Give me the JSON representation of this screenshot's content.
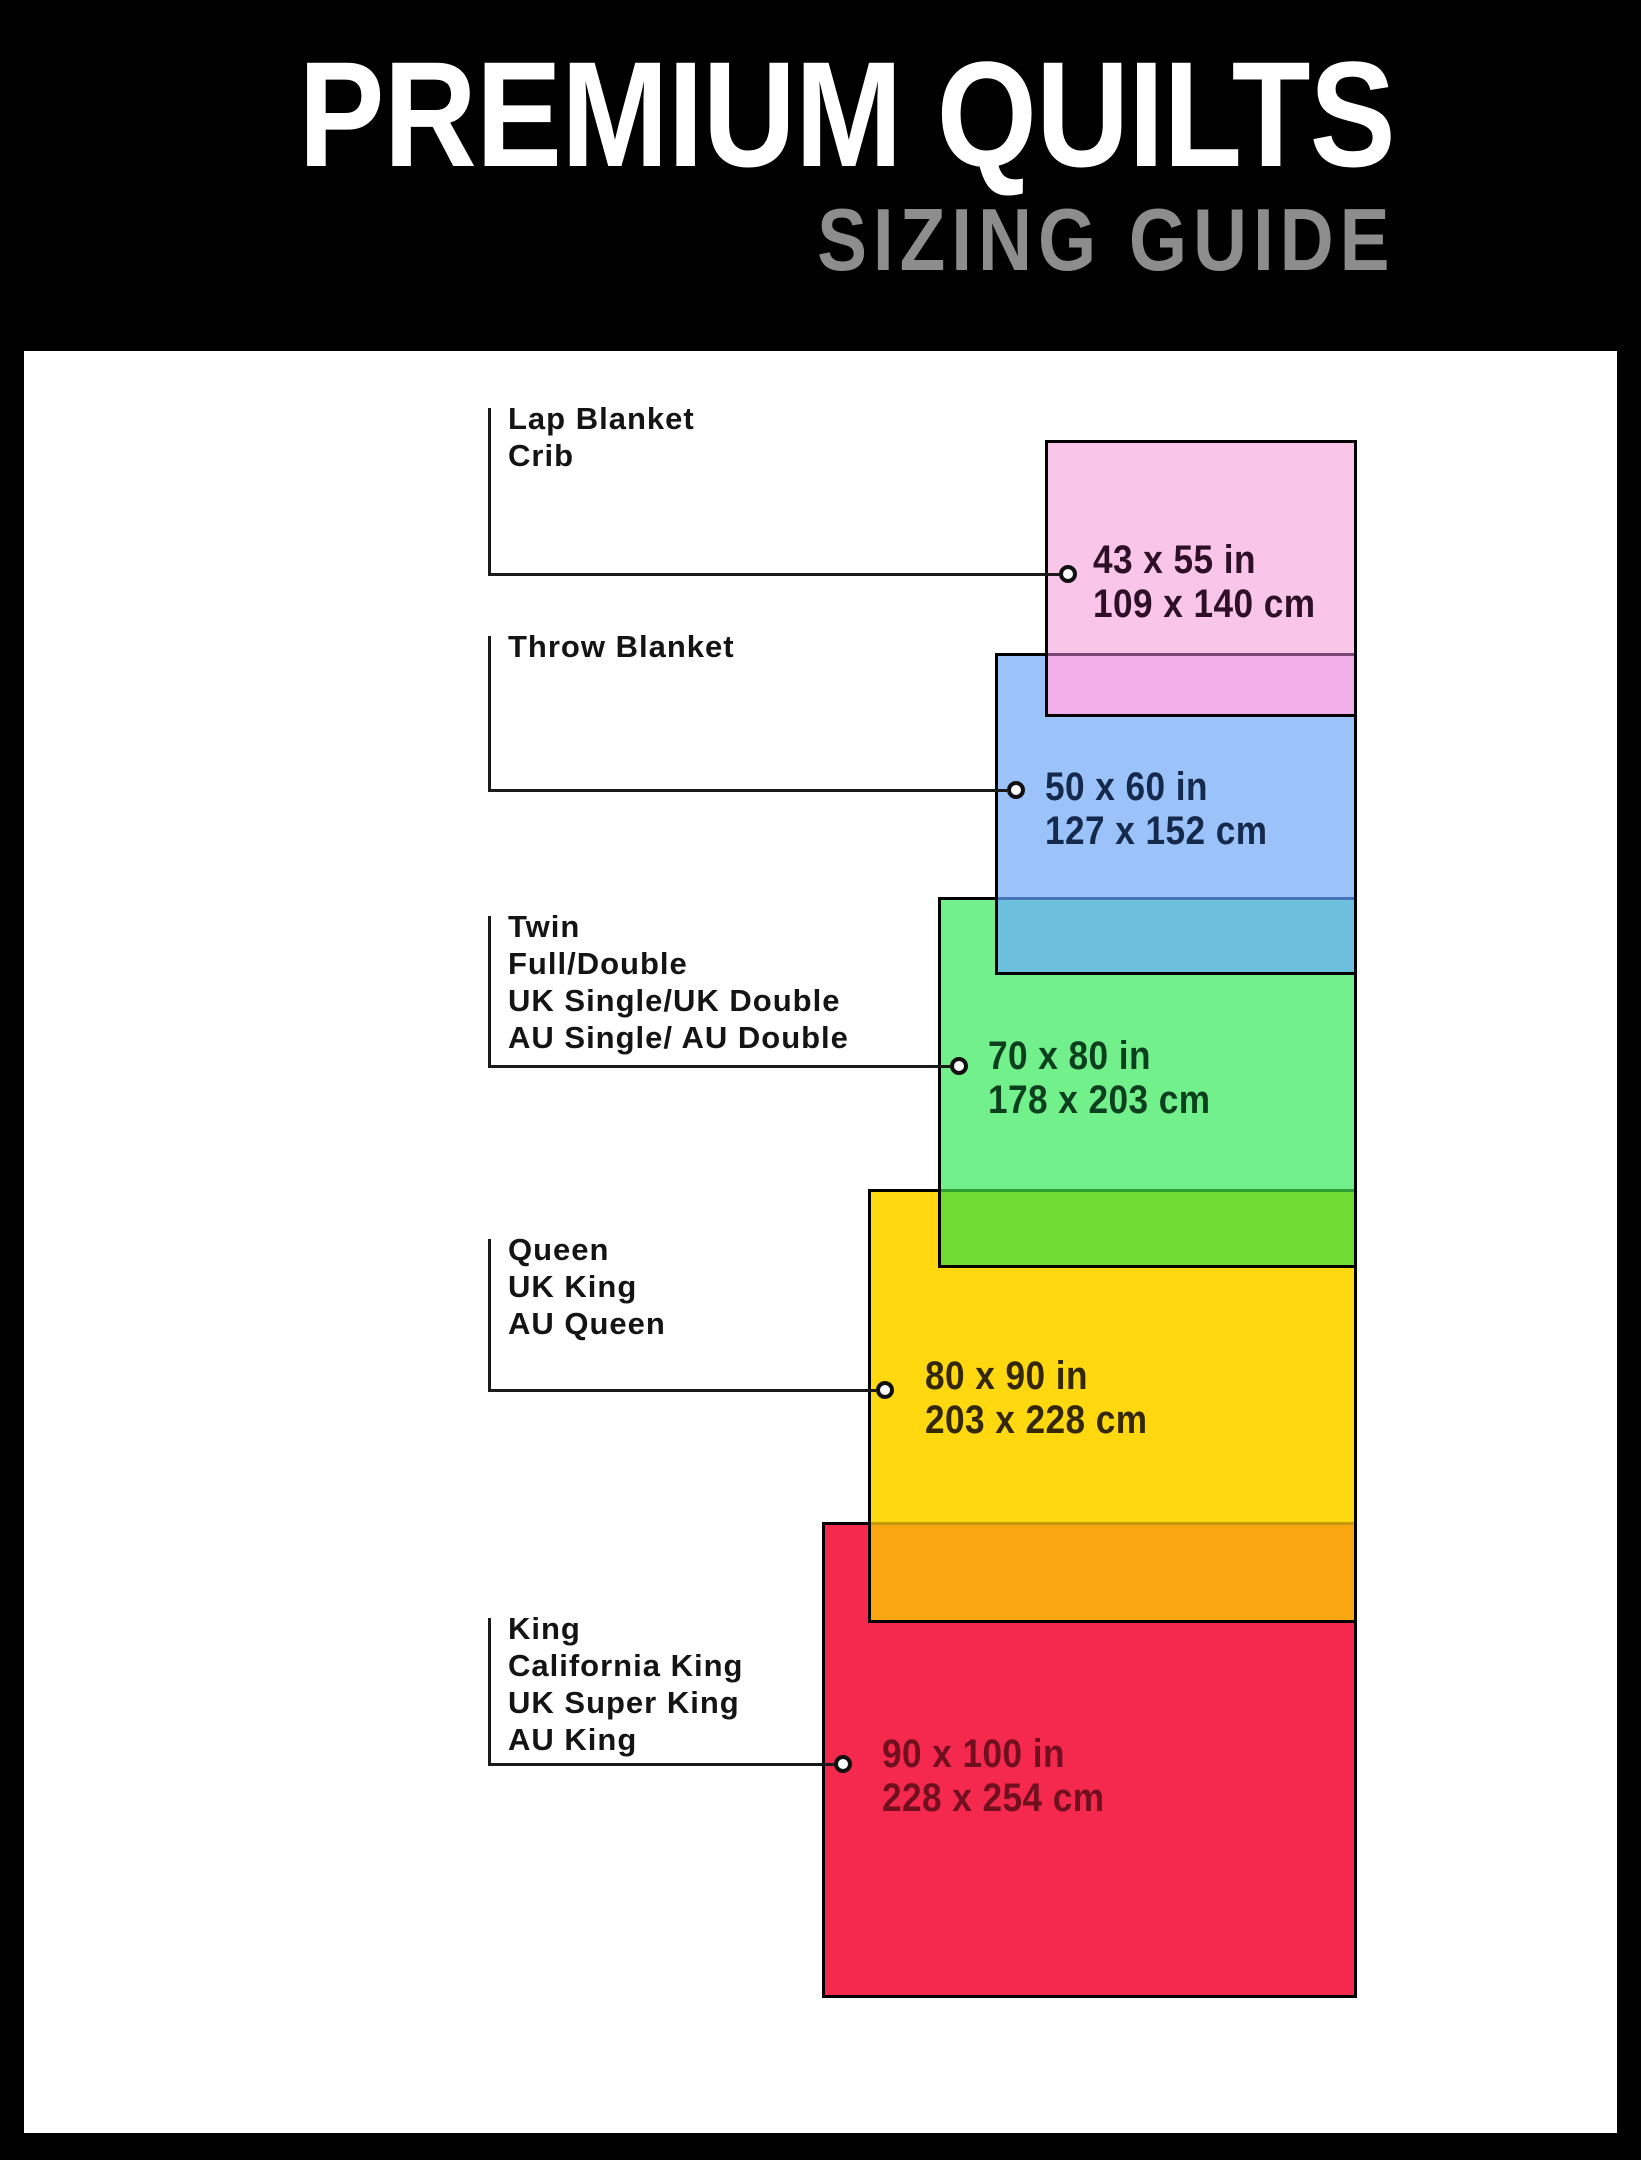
{
  "header": {
    "title": "PREMIUM QUILTS",
    "subtitle": "SIZING GUIDE"
  },
  "colors": {
    "background": "#000000",
    "panel": "#ffffff",
    "title_text": "#ffffff",
    "subtitle_text": "#8d8d8d",
    "line": "#1a1a1a",
    "label_text": "#141414"
  },
  "layout": {
    "right_edge": 1357,
    "bracket_x": 488,
    "label_x": 508
  },
  "sizes": [
    {
      "slug": "lap-blanket-crib",
      "labels": [
        "Lap Blanket",
        "Crib"
      ],
      "inches": "43 x 55 in",
      "cm": "109 x 140 cm",
      "fill": "#f9c6e9",
      "text_color": "#2d1026",
      "rect": {
        "left": 1045,
        "top": 440,
        "height": 277
      },
      "label_top": 400,
      "bracket_top": 408,
      "leader_y": 574,
      "dot_x": 1068,
      "size_text": {
        "left": 1093,
        "top": 538
      }
    },
    {
      "slug": "throw-blanket",
      "labels": [
        "Throw Blanket"
      ],
      "inches": "50 x 60 in",
      "cm": "127 x 152 cm",
      "fill": "#9cc3f9",
      "text_color": "#15294d",
      "rect": {
        "left": 995,
        "top": 653,
        "height": 322
      },
      "label_top": 628,
      "bracket_top": 636,
      "leader_y": 790,
      "dot_x": 1016,
      "size_text": {
        "left": 1045,
        "top": 765
      }
    },
    {
      "slug": "twin-full-double",
      "labels": [
        "Twin",
        "Full/Double",
        "UK Single/UK Double",
        "AU Single/ AU Double"
      ],
      "inches": "70 x 80 in",
      "cm": "178 x 203 cm",
      "fill": "#72f08c",
      "text_color": "#0c3f1e",
      "rect": {
        "left": 938,
        "top": 897,
        "height": 371
      },
      "label_top": 908,
      "bracket_top": 916,
      "leader_y": 1066,
      "dot_x": 959,
      "size_text": {
        "left": 988,
        "top": 1034
      }
    },
    {
      "slug": "queen-uk-king",
      "labels": [
        "Queen",
        "UK King",
        "AU Queen"
      ],
      "inches": "80 x 90 in",
      "cm": "203 x 228 cm",
      "fill": "#ffd80f",
      "text_color": "#332803",
      "rect": {
        "left": 868,
        "top": 1189,
        "height": 434
      },
      "label_top": 1231,
      "bracket_top": 1239,
      "leader_y": 1390,
      "dot_x": 885,
      "size_text": {
        "left": 925,
        "top": 1354
      }
    },
    {
      "slug": "king-california-king",
      "labels": [
        "King",
        "California King",
        "UK Super King",
        "AU King"
      ],
      "inches": "90 x 100 in",
      "cm": "228 x 254 cm",
      "fill": "#f5294d",
      "text_color": "#70101f",
      "rect": {
        "left": 822,
        "top": 1522,
        "height": 476
      },
      "label_top": 1610,
      "bracket_top": 1618,
      "leader_y": 1764,
      "dot_x": 843,
      "size_text": {
        "left": 882,
        "top": 1732
      }
    }
  ],
  "overlaps": [
    {
      "upper": 0,
      "lower": 1,
      "fill": "#f2aee9",
      "line": "#7a4878"
    },
    {
      "upper": 1,
      "lower": 2,
      "fill": "#6cc0dd",
      "line": "#4673b8"
    },
    {
      "upper": 2,
      "lower": 3,
      "fill": "#6edc33",
      "line": "#2f9e33"
    },
    {
      "upper": 3,
      "lower": 4,
      "fill": "#faa512",
      "line": "#c6990a"
    }
  ]
}
